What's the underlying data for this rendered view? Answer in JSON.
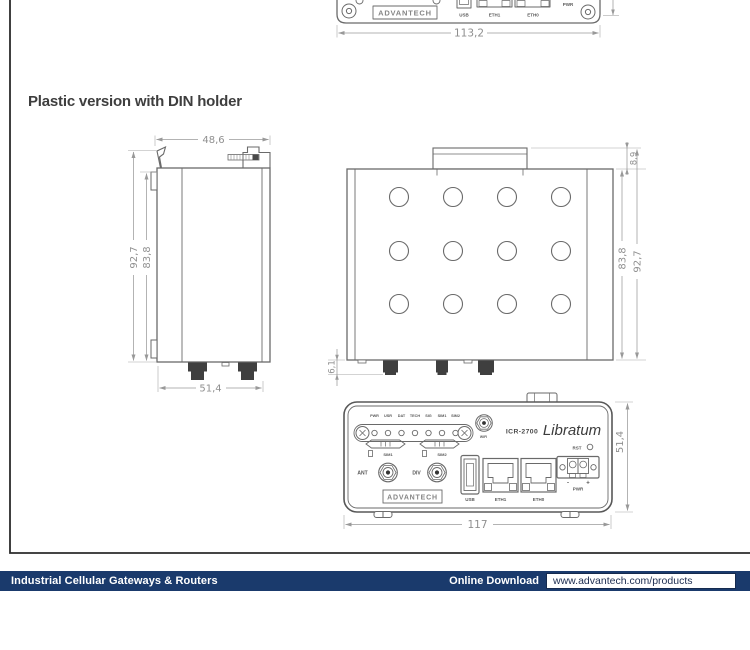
{
  "heading": "Plastic version with DIN holder",
  "footer": {
    "category": "Industrial Cellular Gateways & Routers",
    "online_download": "Online Download",
    "url": "www.advantech.com/products",
    "bar_color": "#1a3a6c"
  },
  "compact_front_view": {
    "logo": "ADVANTECH",
    "usb_label": "USB",
    "eth1_label": "ETH1",
    "eth0_label": "ETH0",
    "pwr_label": "PWR",
    "width_dim": "113,2"
  },
  "side_view": {
    "top_width_dim": "48,6",
    "outer_height_dim": "92,7",
    "body_height_dim": "83,8",
    "bottom_width_dim": "51,4"
  },
  "top_view": {
    "din_tab_dim": "8,9",
    "body_height_dim": "83,8",
    "outer_height_dim": "92,7",
    "connector_dim": "6,1",
    "hole_grid": {
      "cols": 4,
      "rows": 3
    }
  },
  "front_view": {
    "led_labels": [
      "PWR",
      "USR",
      "DAT",
      "TECH",
      "SIG",
      "SIM1",
      "SIM2"
    ],
    "sim1_label": "SIM1",
    "sim2_label": "SIM2",
    "wifi_label": "WIFI",
    "model": "ICR-2700",
    "series": "Libratum",
    "ant_label": "ANT",
    "div_label": "DIV",
    "usb_label": "USB",
    "eth1_label": "ETH1",
    "eth0_label": "ETH0",
    "rst_label": "RST",
    "minus": "-",
    "plus": "+",
    "pwr_label": "PWR",
    "logo": "ADVANTECH",
    "width_dim": "117",
    "height_dim": "51,4"
  },
  "colors": {
    "drawing_line": "#6a6a6a",
    "dimension": "#8f8f8f",
    "footer_bar": "#1a3a6c"
  }
}
